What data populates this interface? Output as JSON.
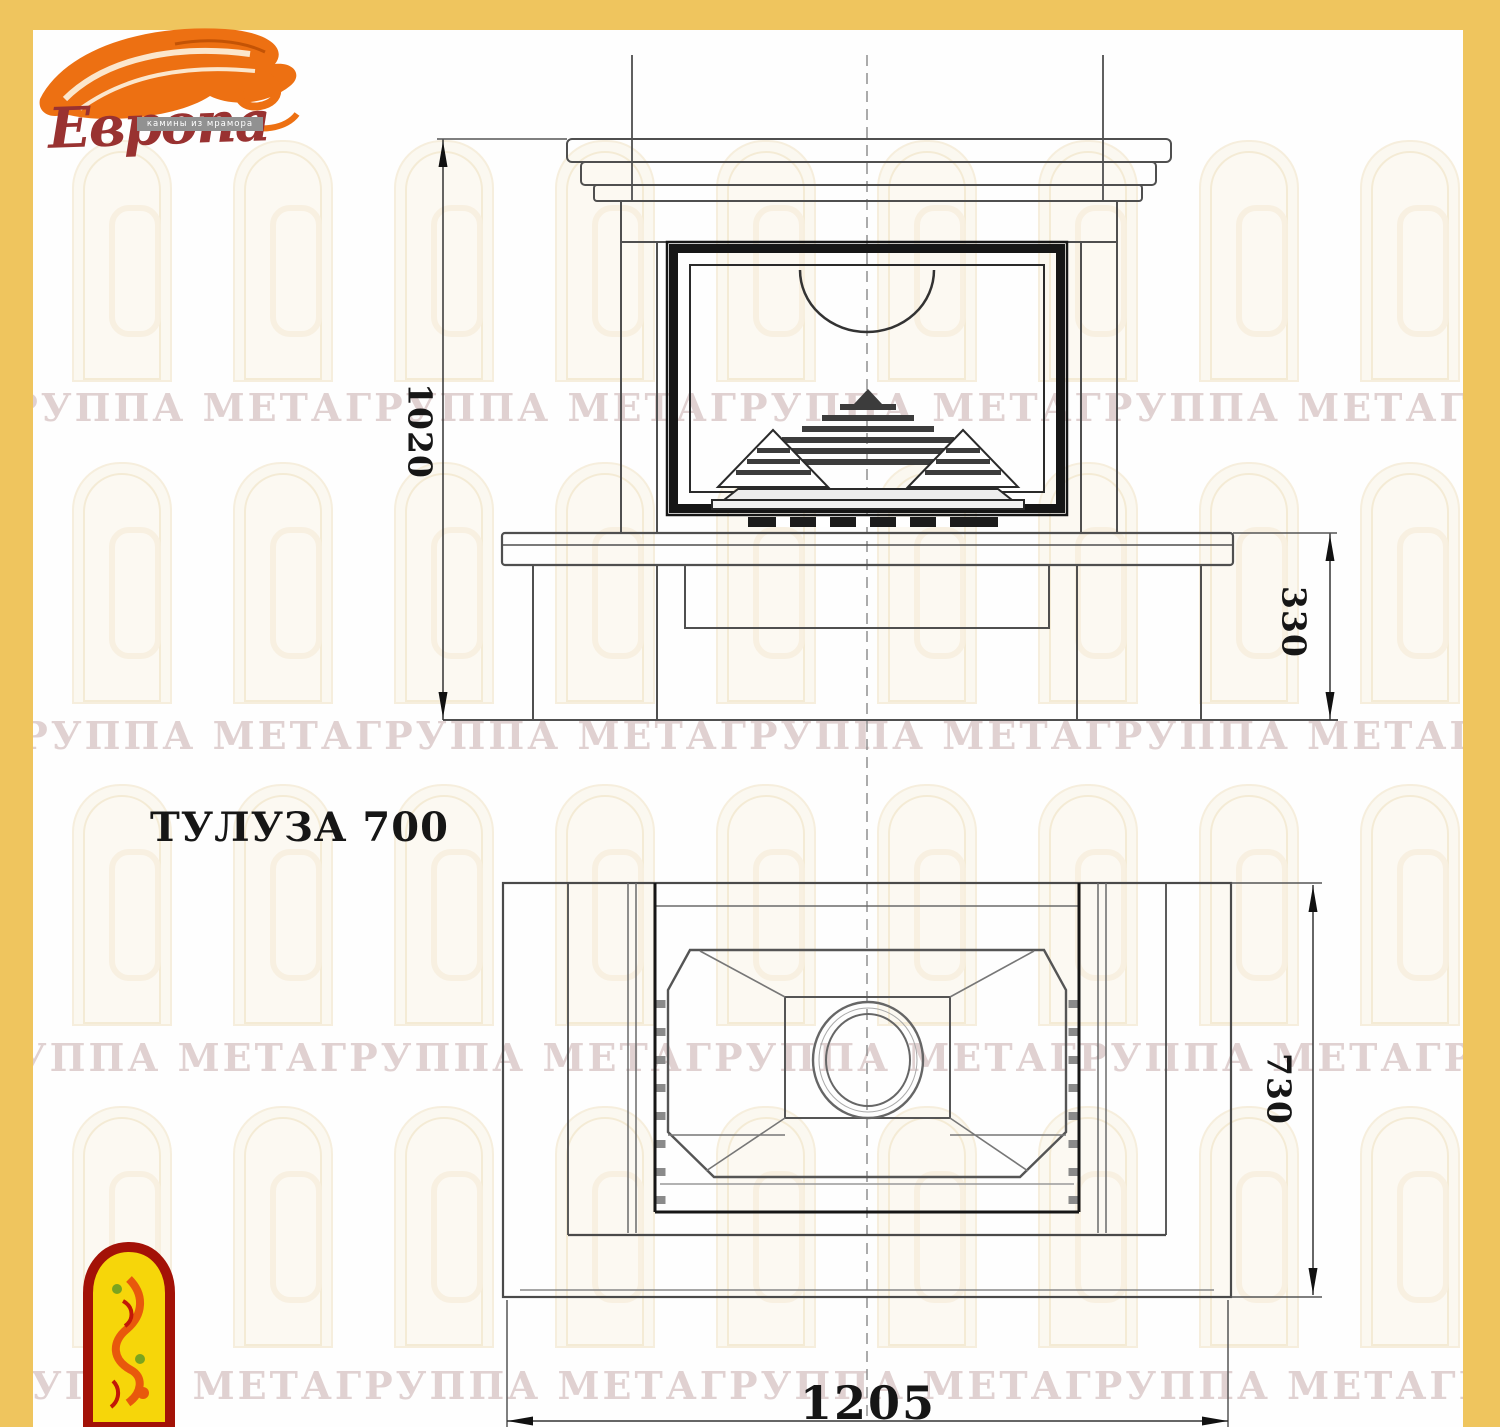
{
  "sheet": {
    "frame_color": "#efc55e",
    "paper_color": "#fefefe"
  },
  "logo": {
    "brand": "Европа",
    "tagline": "камины из мрамора",
    "brand_color": "#993231",
    "flame_color": "#ed7012"
  },
  "drawing": {
    "title": "ТУЛУЗА 700",
    "views": [
      {
        "id": "front-elevation",
        "description": "front view of fireplace with mantel, firebox and base"
      },
      {
        "id": "top-plan",
        "description": "plan view with flue ellipse and chamfered firebox"
      }
    ],
    "dimensions": {
      "overall_height": "1020",
      "base_height": "330",
      "depth": "730",
      "width": "1205"
    },
    "line_color": "#4f4f4f",
    "firebox_line_color": "#161616"
  },
  "watermark": {
    "text": "ГРУППА МЕТАГРУППА МЕТАГРУППА МЕТАГРУППА МЕТАГРУППА МЕТАГРУППА МЕТА",
    "row_count": 4
  }
}
